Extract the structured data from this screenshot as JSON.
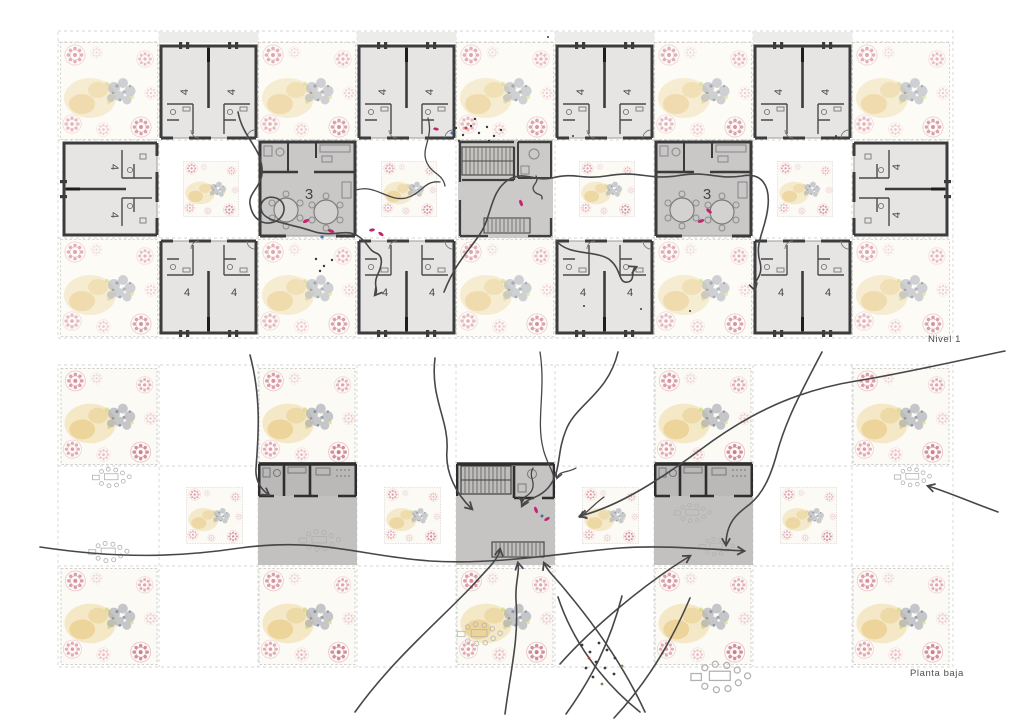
{
  "document": {
    "type": "architectural floor plan collage",
    "background": "#ffffff"
  },
  "labels": {
    "level_top": "Nivel 1",
    "level_bottom": "Planta baja",
    "unit_number": "4",
    "common_room_number": "3"
  },
  "colors": {
    "background": "#ffffff",
    "wall": "#3c3c3c",
    "dwelling_fill": "#e6e5e3",
    "common_fill": "#c9c8c6",
    "stair_fill": "#cbcac8",
    "ground_module_fill": "#c2c1bf",
    "flow_line": "#47474a",
    "accent_pink": "#c2246d",
    "floral_pink": "#d98fa0",
    "floral_gold": "#e3bd64",
    "floral_blue_gray": "#8d94a2",
    "dashed_border": "#c6c6c4"
  },
  "plans": {
    "nivel1": {
      "label": "Nivel 1",
      "grid_cols": 9,
      "grid_rows": 3,
      "rows": [
        [
          "garden",
          "dwellings-4",
          "garden",
          "dwellings-4",
          "garden",
          "dwellings-4",
          "garden",
          "dwellings-4",
          "garden"
        ],
        [
          "dwellings-4-side",
          "patio-garden",
          "common-room-3",
          "patio-garden",
          "stair-core",
          "patio-garden",
          "common-room-3",
          "patio-garden",
          "dwellings-4-side"
        ],
        [
          "garden",
          "dwellings-4",
          "garden",
          "dwellings-4",
          "garden",
          "dwellings-4",
          "garden",
          "dwellings-4",
          "garden"
        ]
      ]
    },
    "planta_baja": {
      "label": "Planta baja",
      "grid_cols": 9,
      "grid_rows": 3,
      "rows": [
        [
          "garden",
          "open",
          "garden",
          "open",
          "open",
          "open",
          "garden",
          "open",
          "garden"
        ],
        [
          "open-furniture",
          "garden-small",
          "common-module",
          "garden-small",
          "stair-core",
          "garden-small",
          "common-module",
          "garden-small",
          "open-furniture"
        ],
        [
          "garden",
          "open",
          "garden",
          "open",
          "garden",
          "open-scatter",
          "garden",
          "open-furniture",
          "garden"
        ]
      ]
    }
  }
}
